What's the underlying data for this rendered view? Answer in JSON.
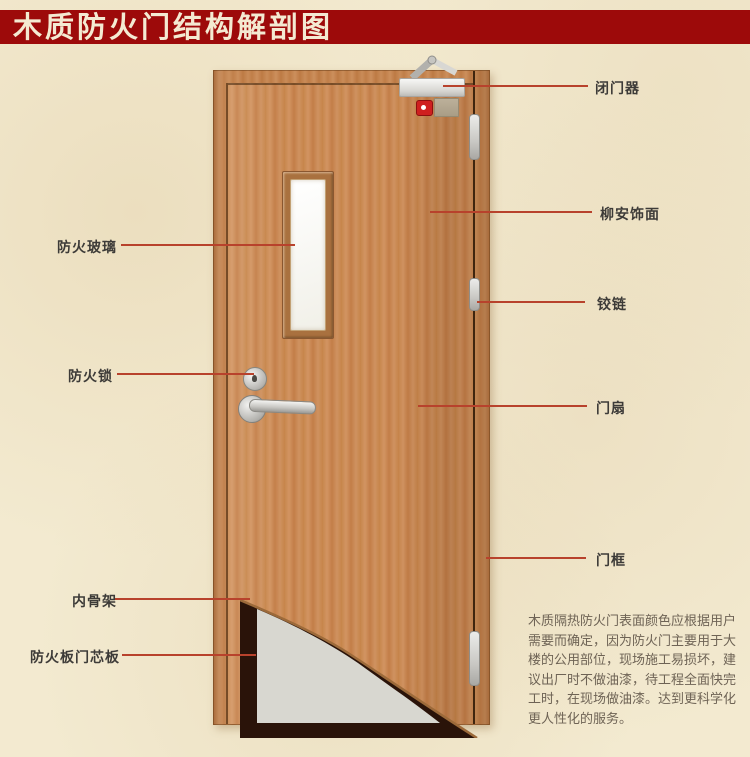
{
  "title": "木质防火门结构解剖图",
  "left_labels": [
    {
      "id": "fire-glass",
      "text": "防火玻璃"
    },
    {
      "id": "fire-lock",
      "text": "防火锁"
    },
    {
      "id": "inner-frame",
      "text": "内骨架"
    },
    {
      "id": "core-board",
      "text": "防火板门芯板"
    }
  ],
  "right_labels": [
    {
      "id": "door-closer",
      "text": "闭门器"
    },
    {
      "id": "veneer",
      "text": "柳安饰面"
    },
    {
      "id": "hinge",
      "text": "铰链"
    },
    {
      "id": "door-leaf",
      "text": "门扇"
    },
    {
      "id": "door-frame",
      "text": "门框"
    }
  ],
  "description": "木质隔热防火门表面颜色应根据用户需要而确定，因为防火门主要用于大楼的公用部位，现场施工易损坏，建议出厂时不做油漆，待工程全面快完工时，在现场做油漆。达到更科学化更人性化的服务。",
  "colors": {
    "banner_bg": "#9d0a0a",
    "banner_text": "#f4ead2",
    "background": "#f3ead0",
    "leader_line": "#b8422c",
    "label_text": "#3d3b38",
    "door_wood": "#c8884f",
    "core_gray": "#d8d7d0",
    "skeleton_dark": "#2a1309"
  }
}
